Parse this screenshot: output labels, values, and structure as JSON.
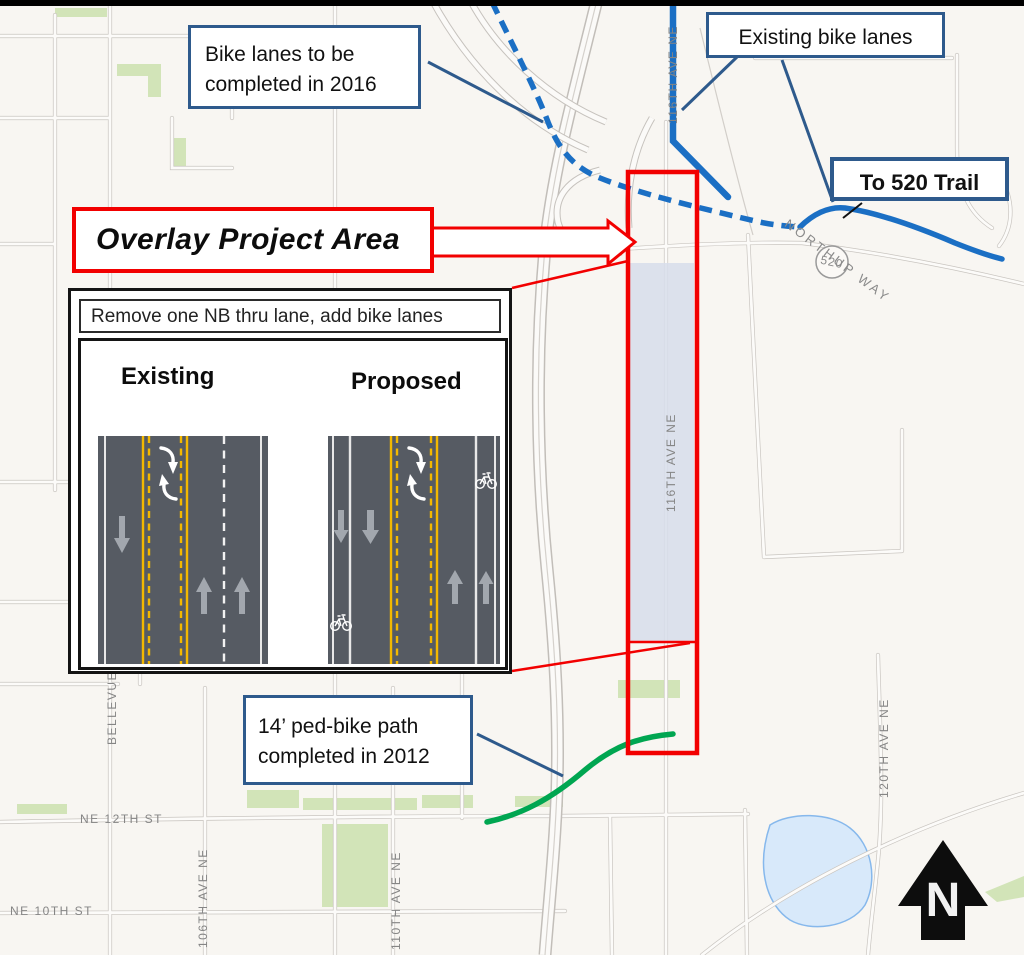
{
  "callouts": {
    "bike_lanes_2016": "Bike lanes to be completed in 2016",
    "existing_bike_lanes": "Existing bike lanes",
    "to_520_trail": "To 520 Trail",
    "overlay_project_area": "Overlay Project Area",
    "ped_bike_path": "14’ ped-bike path completed in 2012"
  },
  "inset": {
    "header": "Remove one NB thru lane, add bike lanes",
    "existing_label": "Existing",
    "proposed_label": "Proposed"
  },
  "map": {
    "street_labels": {
      "ne_12th": "NE 12TH ST",
      "ne_10th": "NE 10TH ST",
      "ave_106": "106TH AVE NE",
      "ave_110": "110TH AVE NE",
      "ave_116_north": "116TH AVE NE",
      "ave_116_project": "116TH AVE NE",
      "ave_120": "120TH AVE NE",
      "northup_way": "NORTHUP WAY",
      "bellevue": "BELLEVUE",
      "route_shield": "520"
    },
    "north_label": "N"
  },
  "colors": {
    "navy_callout": "#2e5a8c",
    "route_blue": "#1b6fc4",
    "path_green": "#00a651",
    "highlight_red": "#f20000",
    "project_shade": "#d7ddeb",
    "park_green": "#d2e4b8",
    "pond_blue": "#d8e9fa"
  }
}
